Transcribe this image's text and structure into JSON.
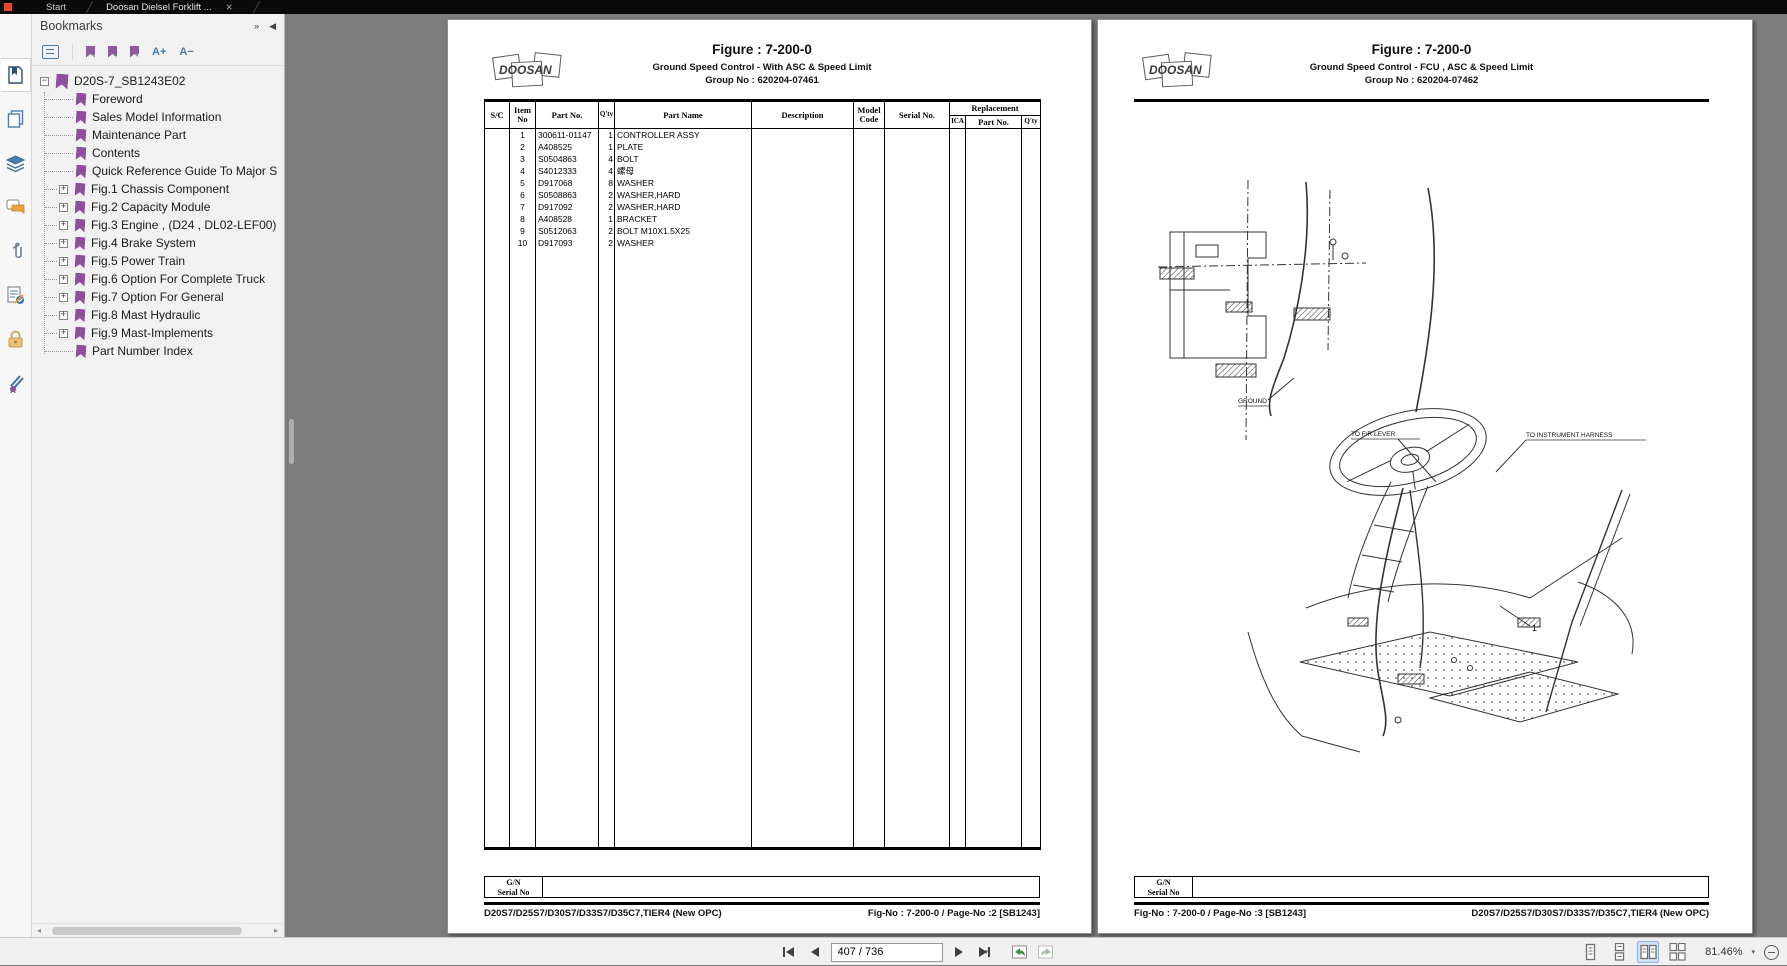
{
  "window": {
    "tabs": [
      {
        "label": "Start"
      },
      {
        "label": "Doosan Dielsel Forklift ..."
      }
    ]
  },
  "glyphs": {
    "close": "✕",
    "caret_down": "▾",
    "plus": "+",
    "minus": "−",
    "panel_forward": "»",
    "panel_back": "◀",
    "scroll_left": "◂",
    "scroll_right": "▸",
    "a_plus": "A+",
    "a_minus": "A−"
  },
  "colors": {
    "doc_background": "#7d7d7d",
    "bookmark_purple": "#8d4f9b",
    "icon_blue": "#4a7ba6",
    "active_layout_bg": "#cfe3f6",
    "lock_gold": "#dcae55",
    "tab_bar": "#0a0a0a"
  },
  "bookmarks_panel": {
    "title": "Bookmarks",
    "root_label": "D20S-7_SB1243E02",
    "items": [
      {
        "label": "Foreword",
        "expandable": false
      },
      {
        "label": "Sales Model Information",
        "expandable": false
      },
      {
        "label": "Maintenance Part",
        "expandable": false
      },
      {
        "label": "Contents",
        "expandable": false
      },
      {
        "label": "Quick Reference Guide To Major S",
        "expandable": false
      },
      {
        "label": "Fig.1 Chassis Component",
        "expandable": true
      },
      {
        "label": "Fig.2 Capacity Module",
        "expandable": true
      },
      {
        "label": "Fig.3 Engine , (D24 , DL02-LEF00)",
        "expandable": true
      },
      {
        "label": "Fig.4 Brake System",
        "expandable": true
      },
      {
        "label": "Fig.5 Power Train",
        "expandable": true
      },
      {
        "label": "Fig.6 Option For Complete Truck",
        "expandable": true
      },
      {
        "label": "Fig.7 Option For General",
        "expandable": true
      },
      {
        "label": "Fig.8 Mast Hydraulic",
        "expandable": true
      },
      {
        "label": "Fig.9 Mast-Implements",
        "expandable": true
      },
      {
        "label": "Part Number Index",
        "expandable": false
      }
    ]
  },
  "left_page": {
    "brand": "DOOSAN",
    "figure": "Figure : 7-200-0",
    "subtitle": "Ground Speed Control - With ASC & Speed Limit",
    "group_no": "Group No :  620204-07461",
    "table": {
      "col_sc": "S/C",
      "col_item": "Item No",
      "col_part": "Part No.",
      "col_qty": "Q'ty",
      "col_name": "Part Name",
      "col_desc": "Description",
      "col_model": "Model Code",
      "col_serial": "Serial No.",
      "col_repl": "Replacement",
      "col_ica": "ICA",
      "col_repl_part": "Part No.",
      "col_repl_qty": "Q'ty",
      "rows": [
        {
          "item": "1",
          "part": "300611-01147",
          "qty": "1",
          "name": "CONTROLLER ASSY"
        },
        {
          "item": "2",
          "part": "A408525",
          "qty": "1",
          "name": "PLATE"
        },
        {
          "item": "3",
          "part": "S0504863",
          "qty": "4",
          "name": "BOLT"
        },
        {
          "item": "4",
          "part": "S4012333",
          "qty": "4",
          "name": "螺母"
        },
        {
          "item": "5",
          "part": "D917068",
          "qty": "8",
          "name": "WASHER"
        },
        {
          "item": "6",
          "part": "S0508863",
          "qty": "2",
          "name": "WASHER,HARD"
        },
        {
          "item": "7",
          "part": "D917092",
          "qty": "2",
          "name": "WASHER,HARD"
        },
        {
          "item": "8",
          "part": "A408528",
          "qty": "1",
          "name": "BRACKET"
        },
        {
          "item": "9",
          "part": "S0512063",
          "qty": "2",
          "name": "BOLT M10X1.5X25"
        },
        {
          "item": "10",
          "part": "D917093",
          "qty": "2",
          "name": "WASHER"
        }
      ]
    },
    "gn_line1": "G/N",
    "gn_line2": "Serial No",
    "footer_left": "D20S7/D25S7/D30S7/D33S7/D35C7,TIER4 (New OPC)",
    "footer_right": "Fig-No : 7-200-0 / Page-No :2 [SB1243]"
  },
  "right_page": {
    "brand": "DOOSAN",
    "figure": "Figure : 7-200-0",
    "subtitle": "Ground Speed Control - FCU , ASC & Speed Limit",
    "group_no": "Group No :  620204-07462",
    "labels": {
      "ground": "GROUND",
      "fr_lever": "TO F/R LEVER",
      "instrument": "TO INSTRUMENT HARNESS",
      "callout_1": "1"
    },
    "gn_line1": "G/N",
    "gn_line2": "Serial No",
    "footer_left": "Fig-No : 7-200-0 / Page-No :3 [SB1243]",
    "footer_right": "D20S7/D25S7/D30S7/D33S7/D35C7,TIER4 (New OPC)"
  },
  "statusbar": {
    "page_value": "407 / 736",
    "zoom_value": "81.46%"
  }
}
